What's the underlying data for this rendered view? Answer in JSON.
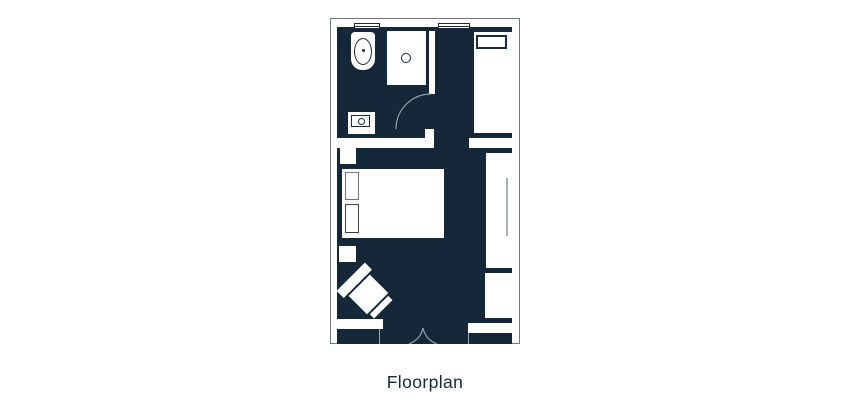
{
  "page": {
    "caption": "Floorplan"
  },
  "colors": {
    "page-bg": "#FFFFFF",
    "interior": "#142839",
    "fixture-fill": "#FFFFFF",
    "outline": "#6A7884",
    "line-dark": "#1B2C3E",
    "pillow-gray": "#6E757C",
    "pillow-dark": "#39434E",
    "arc": "#90A2AE",
    "jamb": "#9AA5AD",
    "handle": "#8D959C",
    "caption-text": "#16293C"
  },
  "floorplan": {
    "areas": [
      "bathroom",
      "bedroom"
    ],
    "fixtures": [
      "window",
      "window",
      "toilet",
      "shower",
      "sink-vanity",
      "interior-wall",
      "bathroom-door-swing",
      "nightstand",
      "double-bed",
      "pillow",
      "pillow",
      "nightstand",
      "armchair",
      "single-bed",
      "pillow",
      "luggage-shelf",
      "wardrobe",
      "closet",
      "entry-ledge",
      "entry-double-door"
    ]
  }
}
